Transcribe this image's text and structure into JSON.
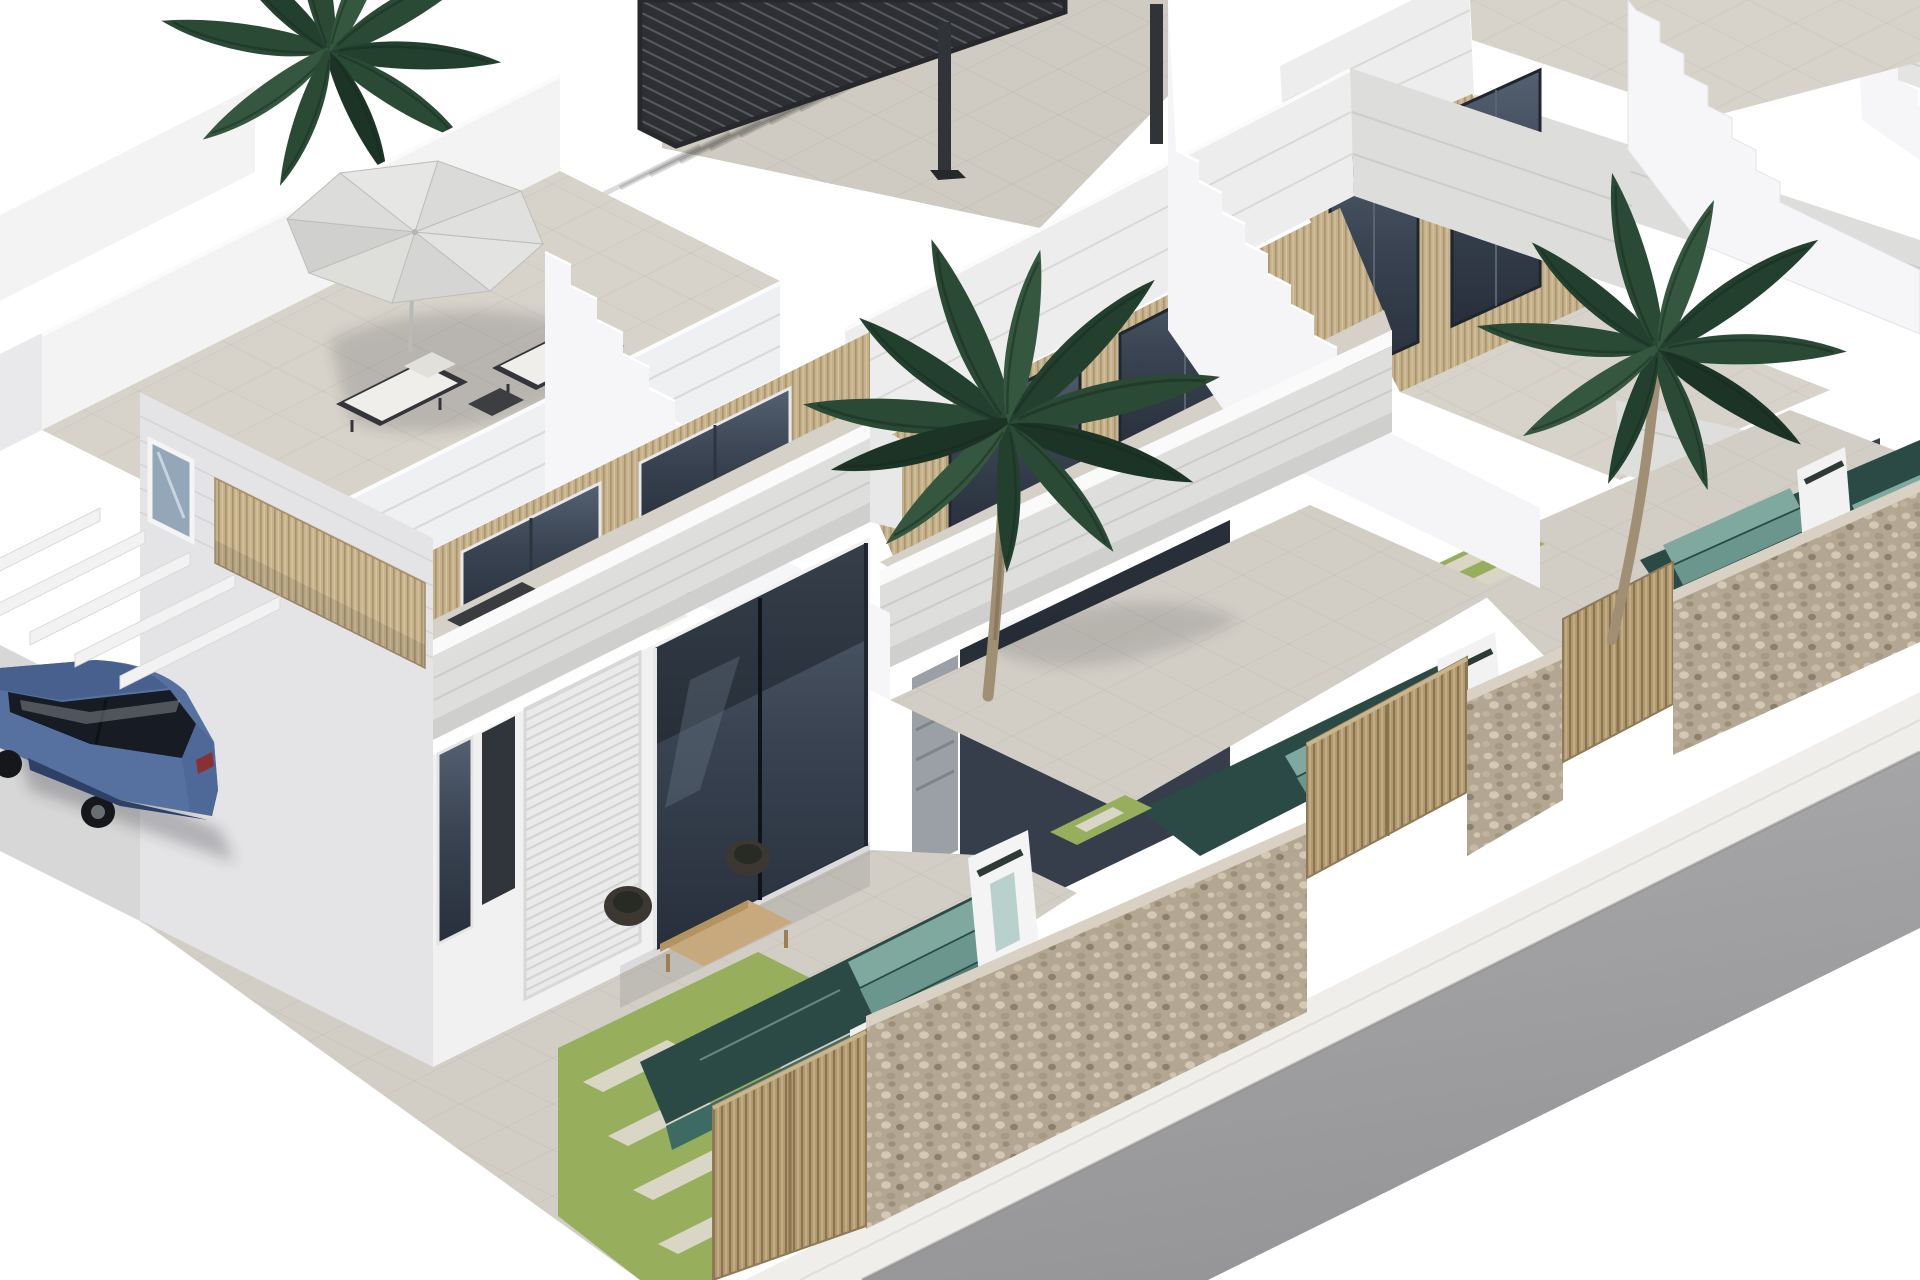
{
  "meta": {
    "title": "New-build villas — exterior 3D render",
    "type": "architectural-render",
    "aria_label": "Isometric 3D rendering of a row of modern white Mediterranean townhouses with roof terraces, a parasol with sun loungers, a black louvered pergola, external staircases, palm trees, plunge pools with teal steps, lawns with stepping stones, a stone street wall with wooden slatted gates, a sidewalk and grey road, and a blue sedan parked under white carport beams."
  },
  "palette": {
    "background": "#ffffff",
    "wall_white": "#f3f3f4",
    "wall_shade": "#e6e6e8",
    "band_plank": "#dcdcda",
    "terrace_floor": "#d7d3ca",
    "patio_floor": "#d2cec6",
    "glass_dark": "#353e4a",
    "slat_wood": "#c6b28c",
    "gate_wood": "#b09971",
    "garage_white": "#eaeaea",
    "pergola_black": "#2d2f33",
    "umbrella_gray": "#dadad8",
    "palm_green": "#2b4a36",
    "trunk_brown": "#a08f74",
    "grass_green": "#97ae5c",
    "stone_wall": "#b3a693",
    "pool_deep": "#2b4a46",
    "pool_step": "#7fa89f",
    "road_gray": "#a2a2a4",
    "sidewalk": "#efeeea",
    "car_blue": "#56719f",
    "shadow": "#1c1f26"
  },
  "scene": {
    "houses": [
      {
        "id": "house-1",
        "features": [
          "roof-terrace",
          "parasol",
          "sun-loungers",
          "balcony-dining-set",
          "carport-beams",
          "garage",
          "porch-lounge",
          "plunge-pool",
          "waterfall-blade",
          "lawn-stepping-stones",
          "wooden-gate"
        ]
      },
      {
        "id": "house-2",
        "features": [
          "roof-terrace",
          "louvered-pergola",
          "external-staircase",
          "balcony",
          "plunge-pool",
          "waterfall-blade",
          "wooden-gate"
        ]
      },
      {
        "id": "house-3",
        "features": [
          "roof-terrace",
          "external-staircase",
          "balcony",
          "plunge-pool",
          "waterfall-blade",
          "lawn-stepping-stones",
          "wooden-gate"
        ]
      },
      {
        "id": "house-4",
        "features": [
          "partial-edge-view"
        ]
      }
    ],
    "environment": {
      "palm_trees": 3,
      "street": [
        "sidewalk",
        "road"
      ],
      "boundary": "stone wall with wooden slatted gates"
    },
    "vehicle": {
      "type": "sedan",
      "color_name": "blue"
    }
  }
}
